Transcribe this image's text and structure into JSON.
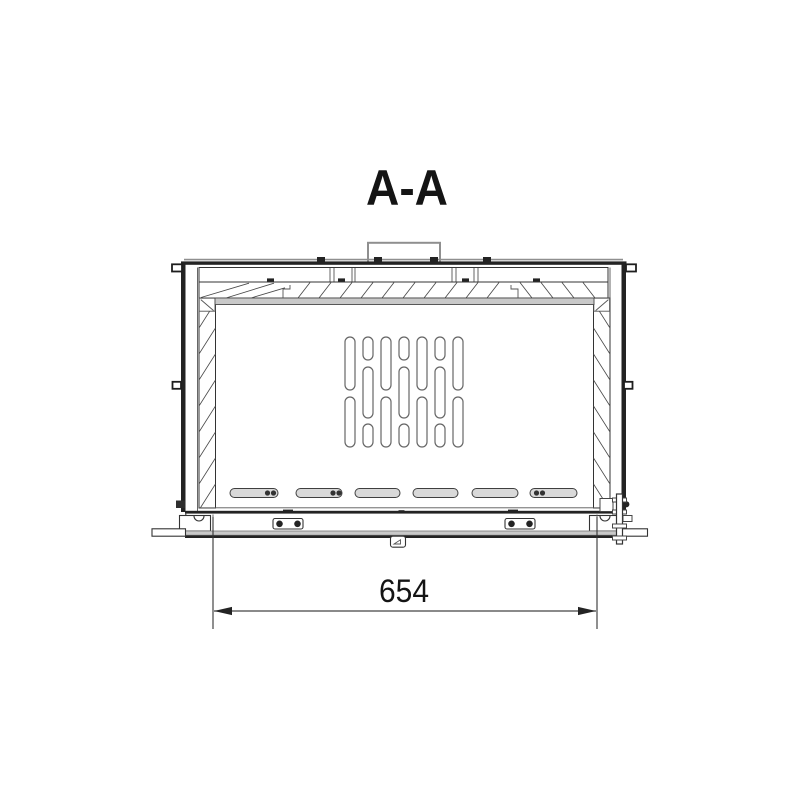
{
  "drawing": {
    "section_title": "A-A",
    "dimension_label": "654"
  },
  "colors": {
    "background": "#ffffff",
    "line_dark": "#222222",
    "line_medium": "#3c3c3c",
    "line_light_gray": "#8f8f8f",
    "fill_light_gray": "#d9d9d9",
    "fill_mid_gray": "#c9c9c9"
  },
  "parts": {
    "names": [
      "flue-collar",
      "top-cover-panel",
      "insulation-hatching",
      "firebox-back-panel",
      "vent-slot-grid",
      "bottom-air-slots",
      "base-frame",
      "door-latch",
      "width-dimension"
    ],
    "vent_grid": {
      "columns": 7,
      "pattern": "staggered vertical slots"
    },
    "bottom_slots": {
      "count": 6
    }
  }
}
